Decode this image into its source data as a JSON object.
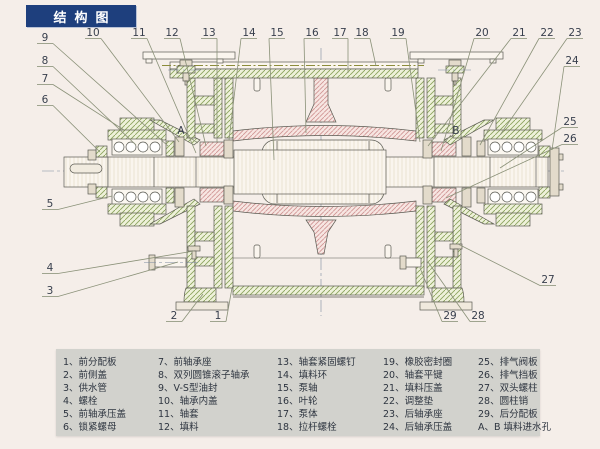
{
  "title": "结构图",
  "colors": {
    "page_bg": "#f5eee9",
    "title_bg": "#1e3f7d",
    "title_text": "#ffffff",
    "legend_bg": "#d2d2cd",
    "outline": "#5a5a52",
    "leader": "#8a9178",
    "callout_text": "#39404e",
    "hatch_green": "#8da45e",
    "hatch_green_bg": "#eef1da",
    "hatch_pink": "#cf9292",
    "hatch_pink_bg": "#f7e6e2"
  },
  "diagram": {
    "callouts": [
      {
        "label": "1",
        "x": 218,
        "y": 316,
        "tx": 232,
        "ty": 288
      },
      {
        "label": "2",
        "x": 174,
        "y": 316,
        "tx": 203,
        "ty": 294
      },
      {
        "label": "3",
        "x": 50,
        "y": 291,
        "tx": 178,
        "ty": 262
      },
      {
        "label": "4",
        "x": 50,
        "y": 268,
        "tx": 194,
        "ty": 251
      },
      {
        "label": "5",
        "x": 50,
        "y": 204,
        "tx": 112,
        "ty": 196
      },
      {
        "label": "6",
        "x": 45,
        "y": 100,
        "tx": 100,
        "ty": 152
      },
      {
        "label": "7",
        "x": 45,
        "y": 79,
        "tx": 124,
        "ty": 130
      },
      {
        "label": "8",
        "x": 45,
        "y": 61,
        "tx": 136,
        "ty": 145
      },
      {
        "label": "9",
        "x": 45,
        "y": 38,
        "tx": 168,
        "ty": 146
      },
      {
        "label": "10",
        "x": 93,
        "y": 33,
        "tx": 179,
        "ty": 142
      },
      {
        "label": "11",
        "x": 139,
        "y": 33,
        "tx": 196,
        "ty": 153
      },
      {
        "label": "12",
        "x": 172,
        "y": 33,
        "tx": 206,
        "ty": 146
      },
      {
        "label": "13",
        "x": 209,
        "y": 33,
        "tx": 217,
        "ty": 142
      },
      {
        "label": "14",
        "x": 249,
        "y": 33,
        "tx": 229,
        "ty": 140
      },
      {
        "label": "15",
        "x": 277,
        "y": 33,
        "tx": 274,
        "ty": 160
      },
      {
        "label": "16",
        "x": 312,
        "y": 33,
        "tx": 306,
        "ty": 133
      },
      {
        "label": "17",
        "x": 340,
        "y": 33,
        "tx": 348,
        "ty": 73
      },
      {
        "label": "18",
        "x": 362,
        "y": 33,
        "tx": 376,
        "ty": 66
      },
      {
        "label": "19",
        "x": 398,
        "y": 33,
        "tx": 420,
        "ty": 142
      },
      {
        "label": "20",
        "x": 482,
        "y": 33,
        "tx": 441,
        "ty": 151
      },
      {
        "label": "21",
        "x": 519,
        "y": 33,
        "tx": 428,
        "ty": 146
      },
      {
        "label": "22",
        "x": 547,
        "y": 33,
        "tx": 480,
        "ty": 145
      },
      {
        "label": "23",
        "x": 575,
        "y": 33,
        "tx": 500,
        "ty": 135
      },
      {
        "label": "24",
        "x": 572,
        "y": 61,
        "tx": 552,
        "ty": 150
      },
      {
        "label": "25",
        "x": 570,
        "y": 122,
        "tx": 500,
        "ty": 168
      },
      {
        "label": "26",
        "x": 570,
        "y": 139,
        "tx": 446,
        "ty": 198
      },
      {
        "label": "27",
        "x": 548,
        "y": 280,
        "tx": 458,
        "ty": 244
      },
      {
        "label": "28",
        "x": 478,
        "y": 316,
        "tx": 428,
        "ty": 262
      },
      {
        "label": "29",
        "x": 450,
        "y": 316,
        "tx": 420,
        "ty": 268
      },
      {
        "label": "A",
        "x": 181,
        "y": 131,
        "tx": 198,
        "ty": 143,
        "ul": false
      },
      {
        "label": "B",
        "x": 456,
        "y": 131,
        "tx": 444,
        "ty": 143,
        "ul": false
      }
    ]
  },
  "legend": {
    "columns": [
      [
        "1、前分配板",
        "2、前侧盖",
        "3、供水管",
        "4、螺栓",
        "5、前轴承压盖",
        "6、锁紧螺母"
      ],
      [
        "7、前轴承座",
        "8、双列圆锥滚子轴承",
        "9、V-S型油封",
        "10、轴承内盖",
        "11、轴套",
        "12、填料"
      ],
      [
        "13、轴套紧固螺钉",
        "14、填料环",
        "15、泵轴",
        "16、叶轮",
        "17、泵体",
        "18、拉杆螺栓"
      ],
      [
        "19、橡胶密封圈",
        "20、轴套平键",
        "21、填料压盖",
        "22、调整垫",
        "23、后轴承座",
        "24、后轴承压盖"
      ],
      [
        "25、排气阀板",
        "26、排气挡板",
        "27、双头螺柱",
        "28、圆柱销",
        "29、后分配板",
        "A、B 填料进水孔"
      ]
    ]
  }
}
